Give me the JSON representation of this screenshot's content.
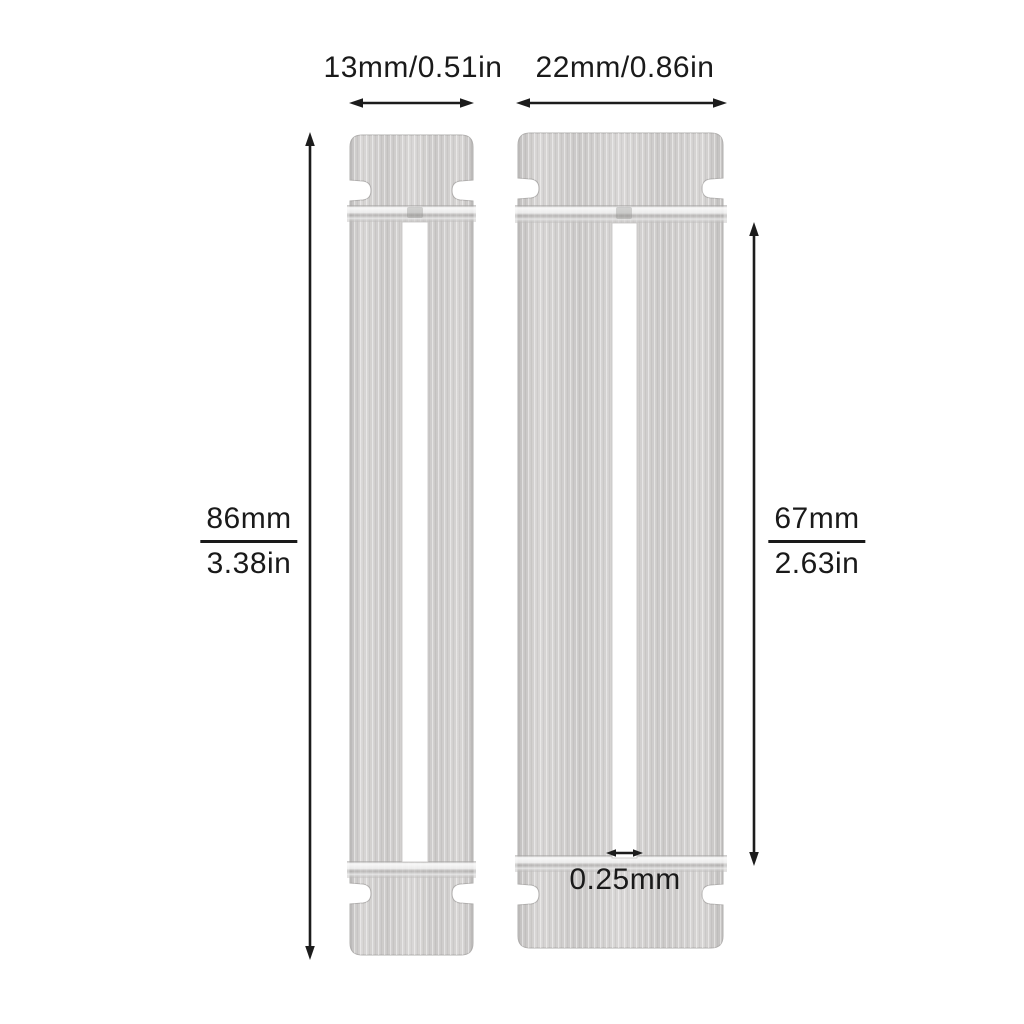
{
  "strips": [
    {
      "name": "narrow-strip",
      "width_label": "13mm/0.51in",
      "height_mm": "86mm",
      "height_in": "3.38in"
    },
    {
      "name": "wide-strip",
      "width_label": "22mm/0.86in",
      "slot_height_mm": "67mm",
      "slot_height_in": "2.63in",
      "slot_width_label": "0.25mm"
    }
  ],
  "colors": {
    "background": "#ffffff",
    "dimension_lines": "#1c1c1c",
    "label_text": "#1a1a1a",
    "metal_light": "#dedede",
    "metal_mid": "#d0cecd",
    "metal_dark": "#c3c1c0",
    "metal_edge": "#b5b3b2",
    "slot_fill": "#ffffff"
  }
}
